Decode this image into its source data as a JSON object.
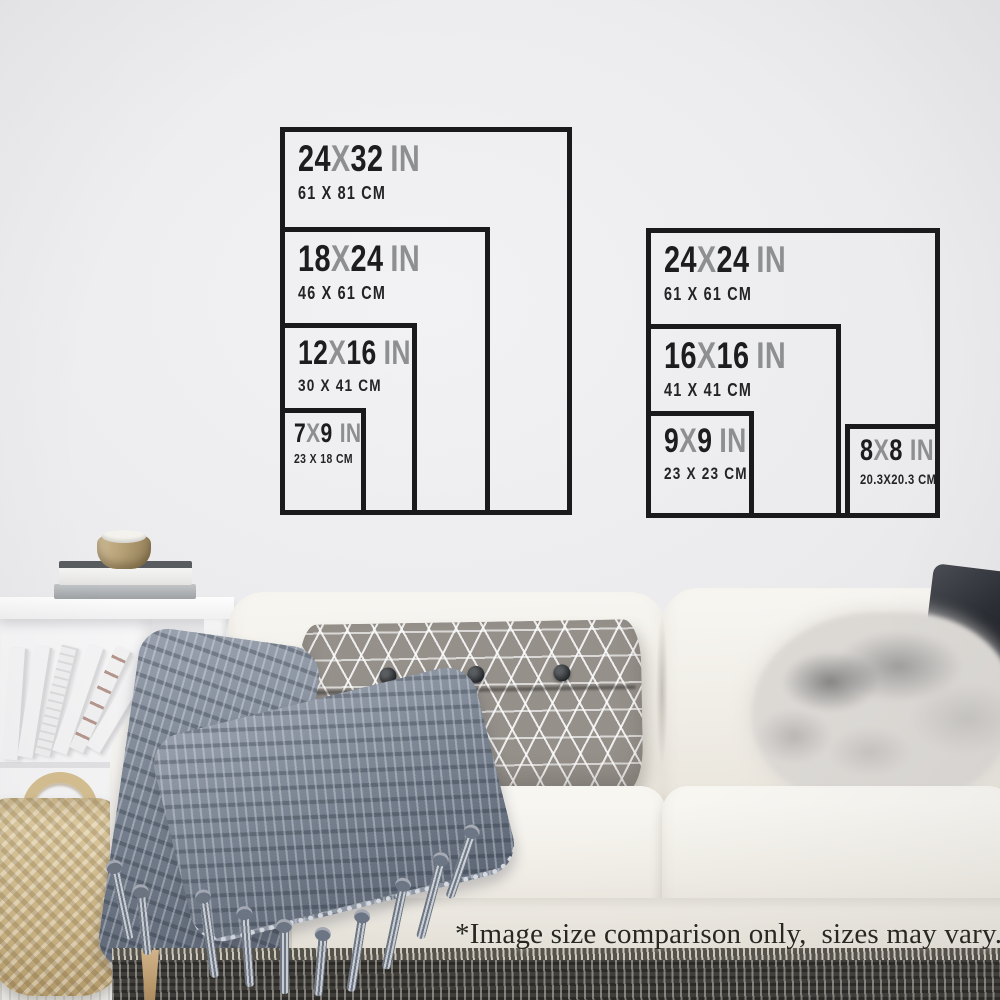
{
  "charts": [
    {
      "name": "portrait-sizes",
      "boxes": [
        {
          "num1": "24",
          "sep": "X",
          "num2": "32",
          "unit": "IN",
          "cm": "61 X 81 CM"
        },
        {
          "num1": "18",
          "sep": "X",
          "num2": "24",
          "unit": "IN",
          "cm": "46 X 61 CM"
        },
        {
          "num1": "12",
          "sep": "X",
          "num2": "16",
          "unit": "IN",
          "cm": "30 X 41 CM"
        },
        {
          "num1": "7",
          "sep": "X",
          "num2": "9",
          "unit": "IN",
          "cm": "23 X 18 CM"
        }
      ]
    },
    {
      "name": "square-sizes",
      "boxes": [
        {
          "num1": "24",
          "sep": "X",
          "num2": "24",
          "unit": "IN",
          "cm": "61 X 61 CM"
        },
        {
          "num1": "16",
          "sep": "X",
          "num2": "16",
          "unit": "IN",
          "cm": "41 X 41 CM"
        },
        {
          "num1": "9",
          "sep": "X",
          "num2": "9",
          "unit": "IN",
          "cm": "23 X 23 CM"
        },
        {
          "num1": "8",
          "sep": "X",
          "num2": "8",
          "unit": "IN",
          "cm": "20.3X20.3 CM"
        }
      ]
    }
  ],
  "disclaimer": "*Image size comparison only,  sizes may vary.",
  "colors": {
    "ink": "#1a1a1c",
    "muted_gray": "#8d8f91",
    "wall": "#e9e9eb",
    "sofa_cream": "#f0ede6",
    "throw_gray_blue": "#757f8d",
    "pillow_gray": "#95908a",
    "basket_tan": "#cdb583"
  }
}
